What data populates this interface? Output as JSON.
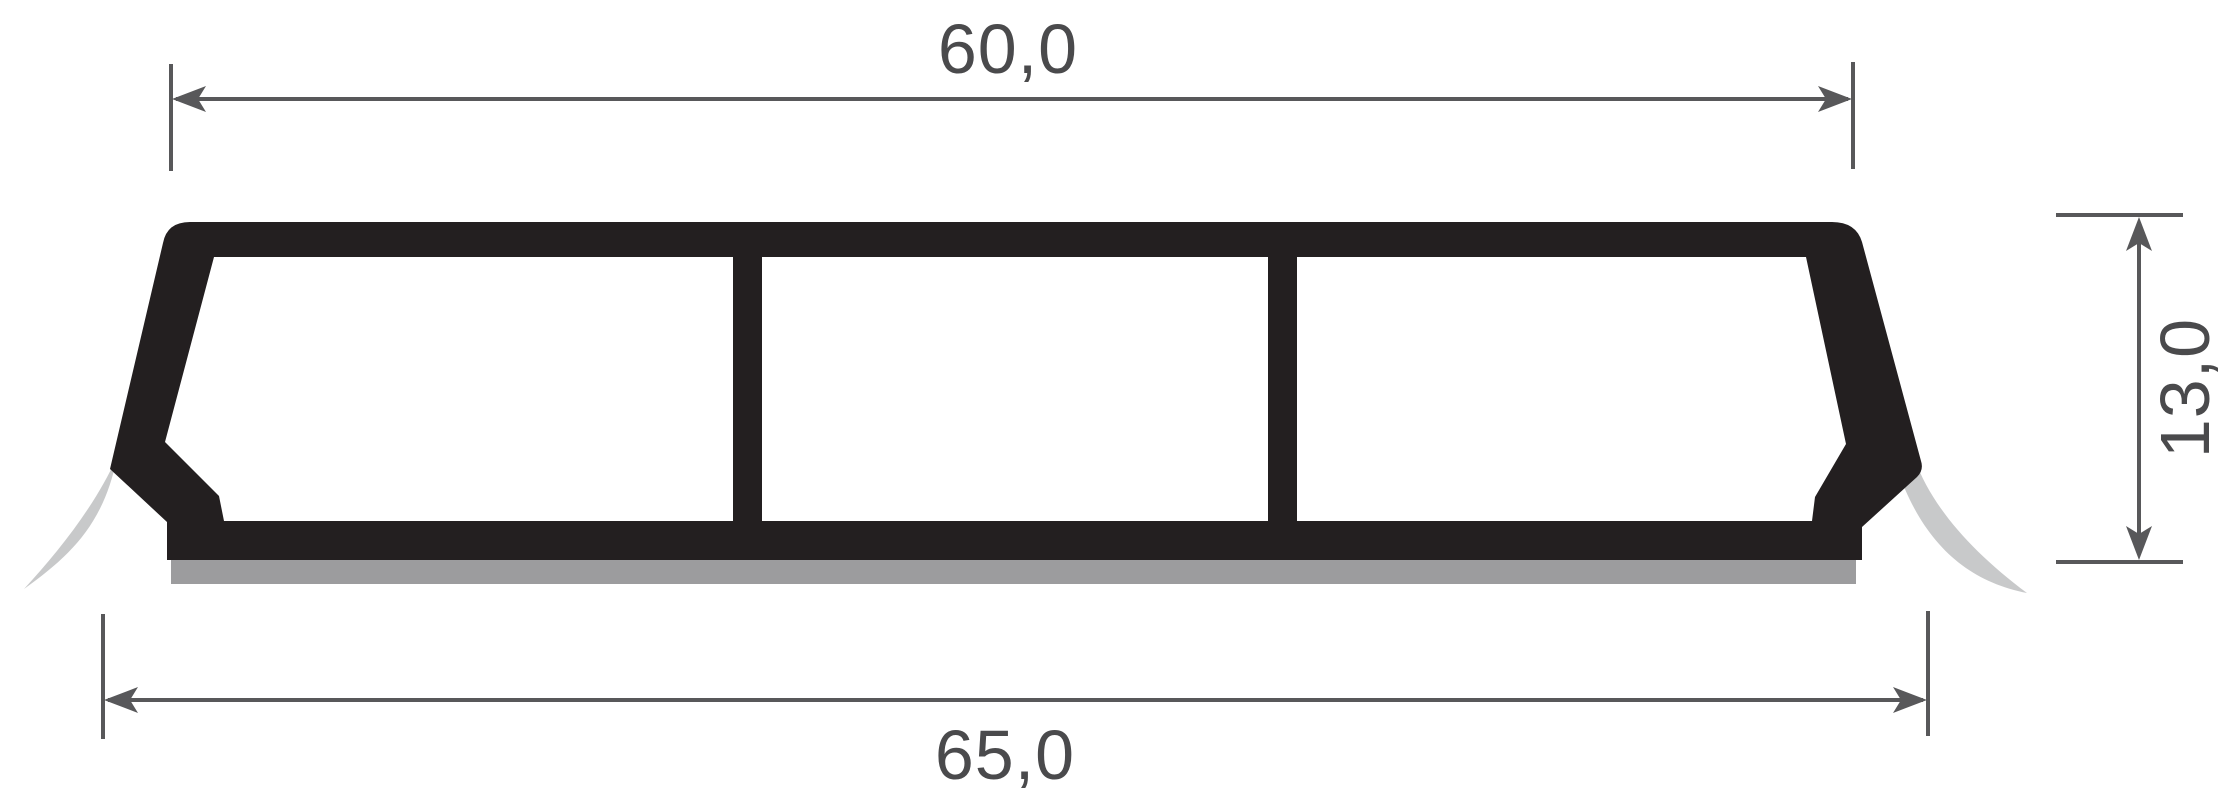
{
  "drawing": {
    "type": "profile-cross-section",
    "dimensions": {
      "top_width": "60,0",
      "overall_width": "65,0",
      "height": "13,0"
    },
    "colors": {
      "profile": "#231f20",
      "adhesive_tape": "#9c9c9e",
      "release_liner": "#c8c9ca",
      "dimension_lines": "#58585a",
      "dimension_text": "#4a4a4c"
    }
  }
}
